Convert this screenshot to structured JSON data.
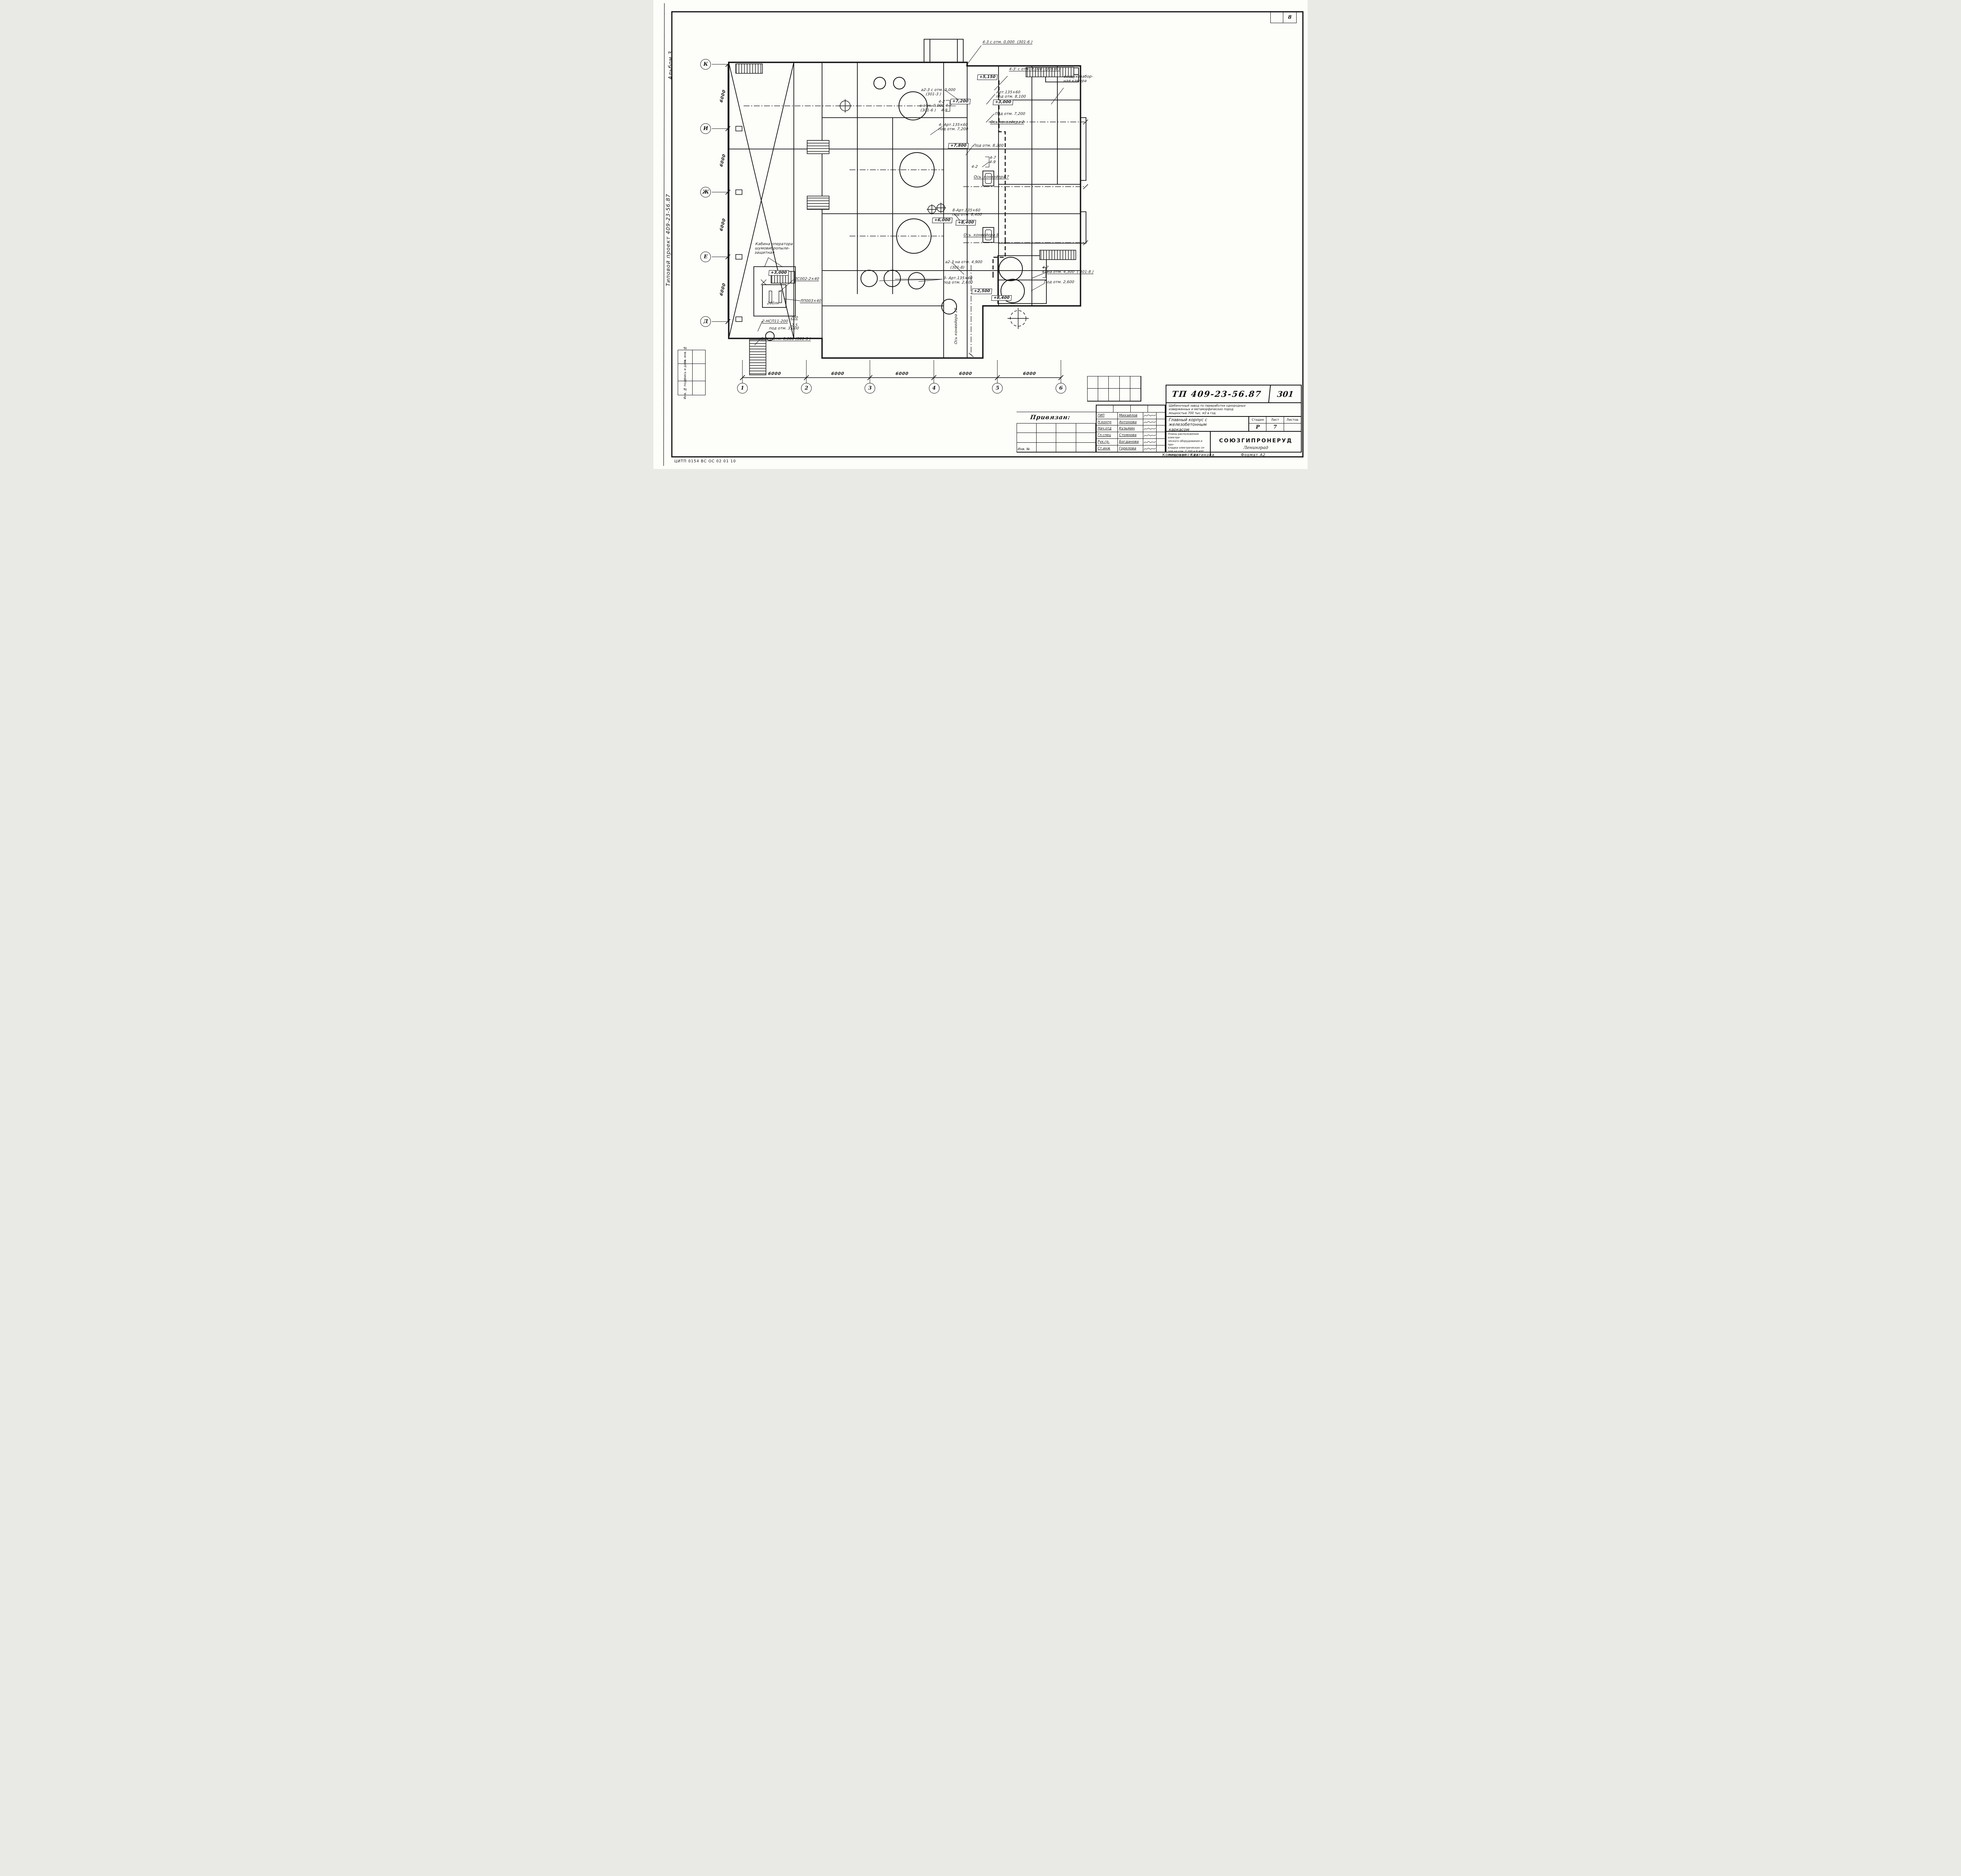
{
  "sheet": {
    "page_number": "8",
    "footer_code": "ЦИТП 0154 ВС  ОС  02  01  10",
    "copied_label": "Копировал:",
    "copied_name": "Хватикова",
    "format_label": "Формат",
    "format_value": "А2"
  },
  "margin": {
    "album": "Альбом 3",
    "project": "Типовой проект 409-23-56.87",
    "stamp_cells": [
      "Взам. инв. №",
      "Подпись и дата",
      "Инв. № подл."
    ]
  },
  "grid": {
    "row_axes": [
      {
        "label": "К",
        "y": 13.7
      },
      {
        "label": "И",
        "y": 27.4
      },
      {
        "label": "Ж",
        "y": 41.0
      },
      {
        "label": "Е",
        "y": 54.8
      },
      {
        "label": "Д",
        "y": 68.6
      }
    ],
    "col_axes": [
      {
        "label": "1",
        "x": 13.6
      },
      {
        "label": "2",
        "x": 23.4
      },
      {
        "label": "3",
        "x": 33.1
      },
      {
        "label": "4",
        "x": 42.9
      },
      {
        "label": "5",
        "x": 52.6
      },
      {
        "label": "6",
        "x": 62.3
      }
    ],
    "row_dims": [
      {
        "text": "6000",
        "y": 20.5
      },
      {
        "text": "6000",
        "y": 34.2
      },
      {
        "text": "6000",
        "y": 47.9
      },
      {
        "text": "6000",
        "y": 61.7
      }
    ],
    "col_dims": [
      {
        "text": "6000",
        "x": 18.5
      },
      {
        "text": "6000",
        "x": 28.2
      },
      {
        "text": "6000",
        "x": 38.0
      },
      {
        "text": "6000",
        "x": 47.7
      },
      {
        "text": "6000",
        "x": 57.5
      }
    ]
  },
  "annotations": [
    {
      "text": "4-3 с отм. 0,000  (301-6 )",
      "x": 50.3,
      "y": 8.5,
      "kind": "u"
    },
    {
      "text": "4-3' с отм. 0,000  (301-6 )",
      "x": 54.4,
      "y": 14.3,
      "kind": "u"
    },
    {
      "text": "воздухозабор-\nная камера",
      "x": 62.7,
      "y": 15.9,
      "kind": "n"
    },
    {
      "text": "+5,150",
      "x": 49.5,
      "y": 15.9,
      "kind": "b"
    },
    {
      "text": "Арт.135×60\nпод отм. 8,100",
      "x": 52.4,
      "y": 19.2,
      "kind": "n"
    },
    {
      "text": "+3,000",
      "x": 51.9,
      "y": 21.2,
      "kind": "b"
    },
    {
      "text": "Под отм. 7,200",
      "x": 52.2,
      "y": 23.8,
      "kind": "n"
    },
    {
      "text": "Ось конвейера 2",
      "x": 51.5,
      "y": 25.6,
      "kind": "u"
    },
    {
      "text": "а2-3 с отм. 0,000\n    (301-3 )",
      "x": 40.9,
      "y": 18.7,
      "kind": "n"
    },
    {
      "text": "4-2",
      "x": 43.6,
      "y": 21.2,
      "kind": "n"
    },
    {
      "text": "с отм. 0,000 4-7",
      "x": 40.7,
      "y": 22.1,
      "kind": "n"
    },
    {
      "text": "(301-6 )    4-9",
      "x": 40.8,
      "y": 23.1,
      "kind": "n"
    },
    {
      "text": "+7,200",
      "x": 45.4,
      "y": 21.1,
      "kind": "b"
    },
    {
      "text": "4- Арт.135×60\nпод отм. 7,200",
      "x": 43.6,
      "y": 26.2,
      "kind": "n"
    },
    {
      "text": "+7,800",
      "x": 45.1,
      "y": 30.5,
      "kind": "b"
    },
    {
      "text": "Под отм. 8,200",
      "x": 48.9,
      "y": 30.6,
      "kind": "n"
    },
    {
      "text": "4-7\n4-9",
      "x": 51.4,
      "y": 33.2,
      "kind": "n"
    },
    {
      "text": "4-2",
      "x": 48.6,
      "y": 35.1,
      "kind": "n"
    },
    {
      "text": "Ось  конвейера 7",
      "x": 49.0,
      "y": 37.3,
      "kind": "u"
    },
    {
      "text": "8-Арт.135×60\nпод отм. 8,400",
      "x": 45.7,
      "y": 44.4,
      "kind": "n"
    },
    {
      "text": "+6,000",
      "x": 42.6,
      "y": 46.4,
      "kind": "b"
    },
    {
      "text": "+8,400",
      "x": 46.2,
      "y": 46.9,
      "kind": "b"
    },
    {
      "text": "Ось  конвейера 8",
      "x": 47.4,
      "y": 49.7,
      "kind": "u"
    },
    {
      "text": "Кабина оператора\nшумовибропыле-\nзащитная",
      "x": 15.5,
      "y": 51.6,
      "kind": "n"
    },
    {
      "text": "+3,000",
      "x": 17.6,
      "y": 57.6,
      "kind": "b"
    },
    {
      "text": "ЛС002-2×40",
      "x": 21.5,
      "y": 59.0,
      "kind": "u"
    },
    {
      "text": "ЛП003×40",
      "x": 22.4,
      "y": 63.7,
      "kind": "u"
    },
    {
      "text": "200лк",
      "x": 17.4,
      "y": 64.2,
      "kind": "n"
    },
    {
      "text": "2-НСП11-200",
      "x": 16.6,
      "y": 68.1,
      "kind": "u"
    },
    {
      "text": "200",
      "x": 21.0,
      "y": 67.3,
      "kind": "u"
    },
    {
      "text": "2,5",
      "x": 21.1,
      "y": 68.9,
      "kind": "n"
    },
    {
      "text": "под отм. 3,000",
      "x": 17.7,
      "y": 69.6,
      "kind": "n"
    },
    {
      "text": "6-1  с отм. 0,000 (301-3 )",
      "x": 16.4,
      "y": 71.8,
      "kind": "u"
    },
    {
      "text": "а2-3 на отм. 4,900",
      "x": 44.6,
      "y": 55.4,
      "kind": "n"
    },
    {
      "text": "(301-8)",
      "x": 45.4,
      "y": 56.6,
      "kind": "n"
    },
    {
      "text": "4-7\n4-9",
      "x": 59.4,
      "y": 56.6,
      "kind": "n"
    },
    {
      "text": "на отм. 4,300  ( 301-8 )",
      "x": 60.2,
      "y": 57.5,
      "kind": "u"
    },
    {
      "text": "Под отм. 2,600",
      "x": 59.7,
      "y": 59.7,
      "kind": "n"
    },
    {
      "text": "3- Арт.135×60\nпод отм. 2,600",
      "x": 44.3,
      "y": 58.9,
      "kind": "n"
    },
    {
      "text": "+2,500",
      "x": 48.7,
      "y": 61.5,
      "kind": "b"
    },
    {
      "text": "+8,400",
      "x": 51.7,
      "y": 63.0,
      "kind": "b"
    },
    {
      "text": "Ось конвейера 10",
      "x": 46.6,
      "y": 72.5,
      "kind": "v"
    }
  ],
  "titleblock": {
    "doc_number": "ТП 409-23-56.87",
    "sheet_code": "301",
    "project_desc": "Щебеночный завод по переработке однородных\nизверженных и метаморфических пород\nмощностью 700 тыс. м3 в год.",
    "object_title": "Главный корпус с\nжелезобетонным\nкаркасом",
    "sheet_title": "Планы расположения электри-\nческого оборудования и про-\nкладки электрических се-\nтей на отм. 7,200 и 8,400\nмежду осями 1-6, Д-К.",
    "stage_label": "Стадия",
    "list_label": "Лист",
    "lists_label": "Листов",
    "stage_value": "Р",
    "list_value": "7",
    "lists_value": "",
    "org_name": "СОЮЗГИПРОНЕРУД",
    "org_city": "Ленинград",
    "bind_label": "Привязан:",
    "inv_label": "Инв. №",
    "signers": [
      {
        "role": "ГИП",
        "name": "Михайлов"
      },
      {
        "role": "Н.контр",
        "name": "Антонова"
      },
      {
        "role": "Нач.отд",
        "name": "Кузьмин"
      },
      {
        "role": "Гл.спец",
        "name": "Стоянова"
      },
      {
        "role": "Рук.гр.",
        "name": "Богданова"
      },
      {
        "role": "Ст.инж",
        "name": "Горелова"
      }
    ]
  }
}
